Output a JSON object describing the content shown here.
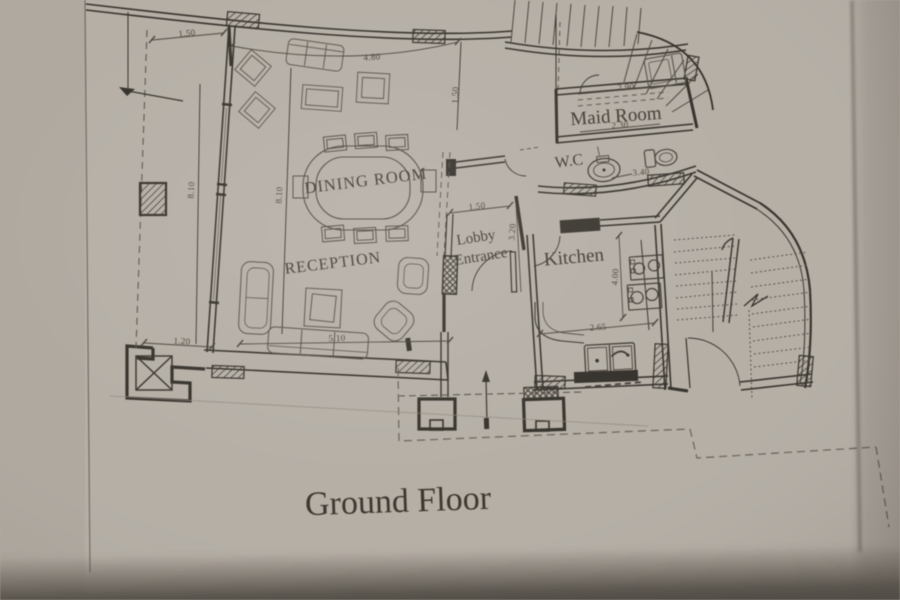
{
  "title": "Ground Floor",
  "labels": {
    "dining_room": "DINING ROOM",
    "reception": "RECEPTION",
    "maid_room": "Maid Room",
    "wc": "W.C",
    "lobby_line1": "Lobby",
    "lobby_line2": "Entrance",
    "kitchen": "Kitchen"
  },
  "dimensions": {
    "top_left_width": "1.50",
    "dining_top_width": "4.80",
    "dining_right_height": "1.50",
    "maid_width_top": "2.90",
    "maid_width_bottom": "2.30",
    "wc_width": "3.40",
    "left_height": "8.10",
    "dining_left_height": "8.10",
    "lobby_width": "1.50",
    "lobby_height": "3.20",
    "reception_width": "5.10",
    "terrace_width": "1.20",
    "kitchen_width": "2.65",
    "kitchen_height": "4.00"
  },
  "colors": {
    "paper": "#b6afa6",
    "ink": "#35312b",
    "furniture_ink": "#5d574e",
    "shadow": "#55504a"
  }
}
